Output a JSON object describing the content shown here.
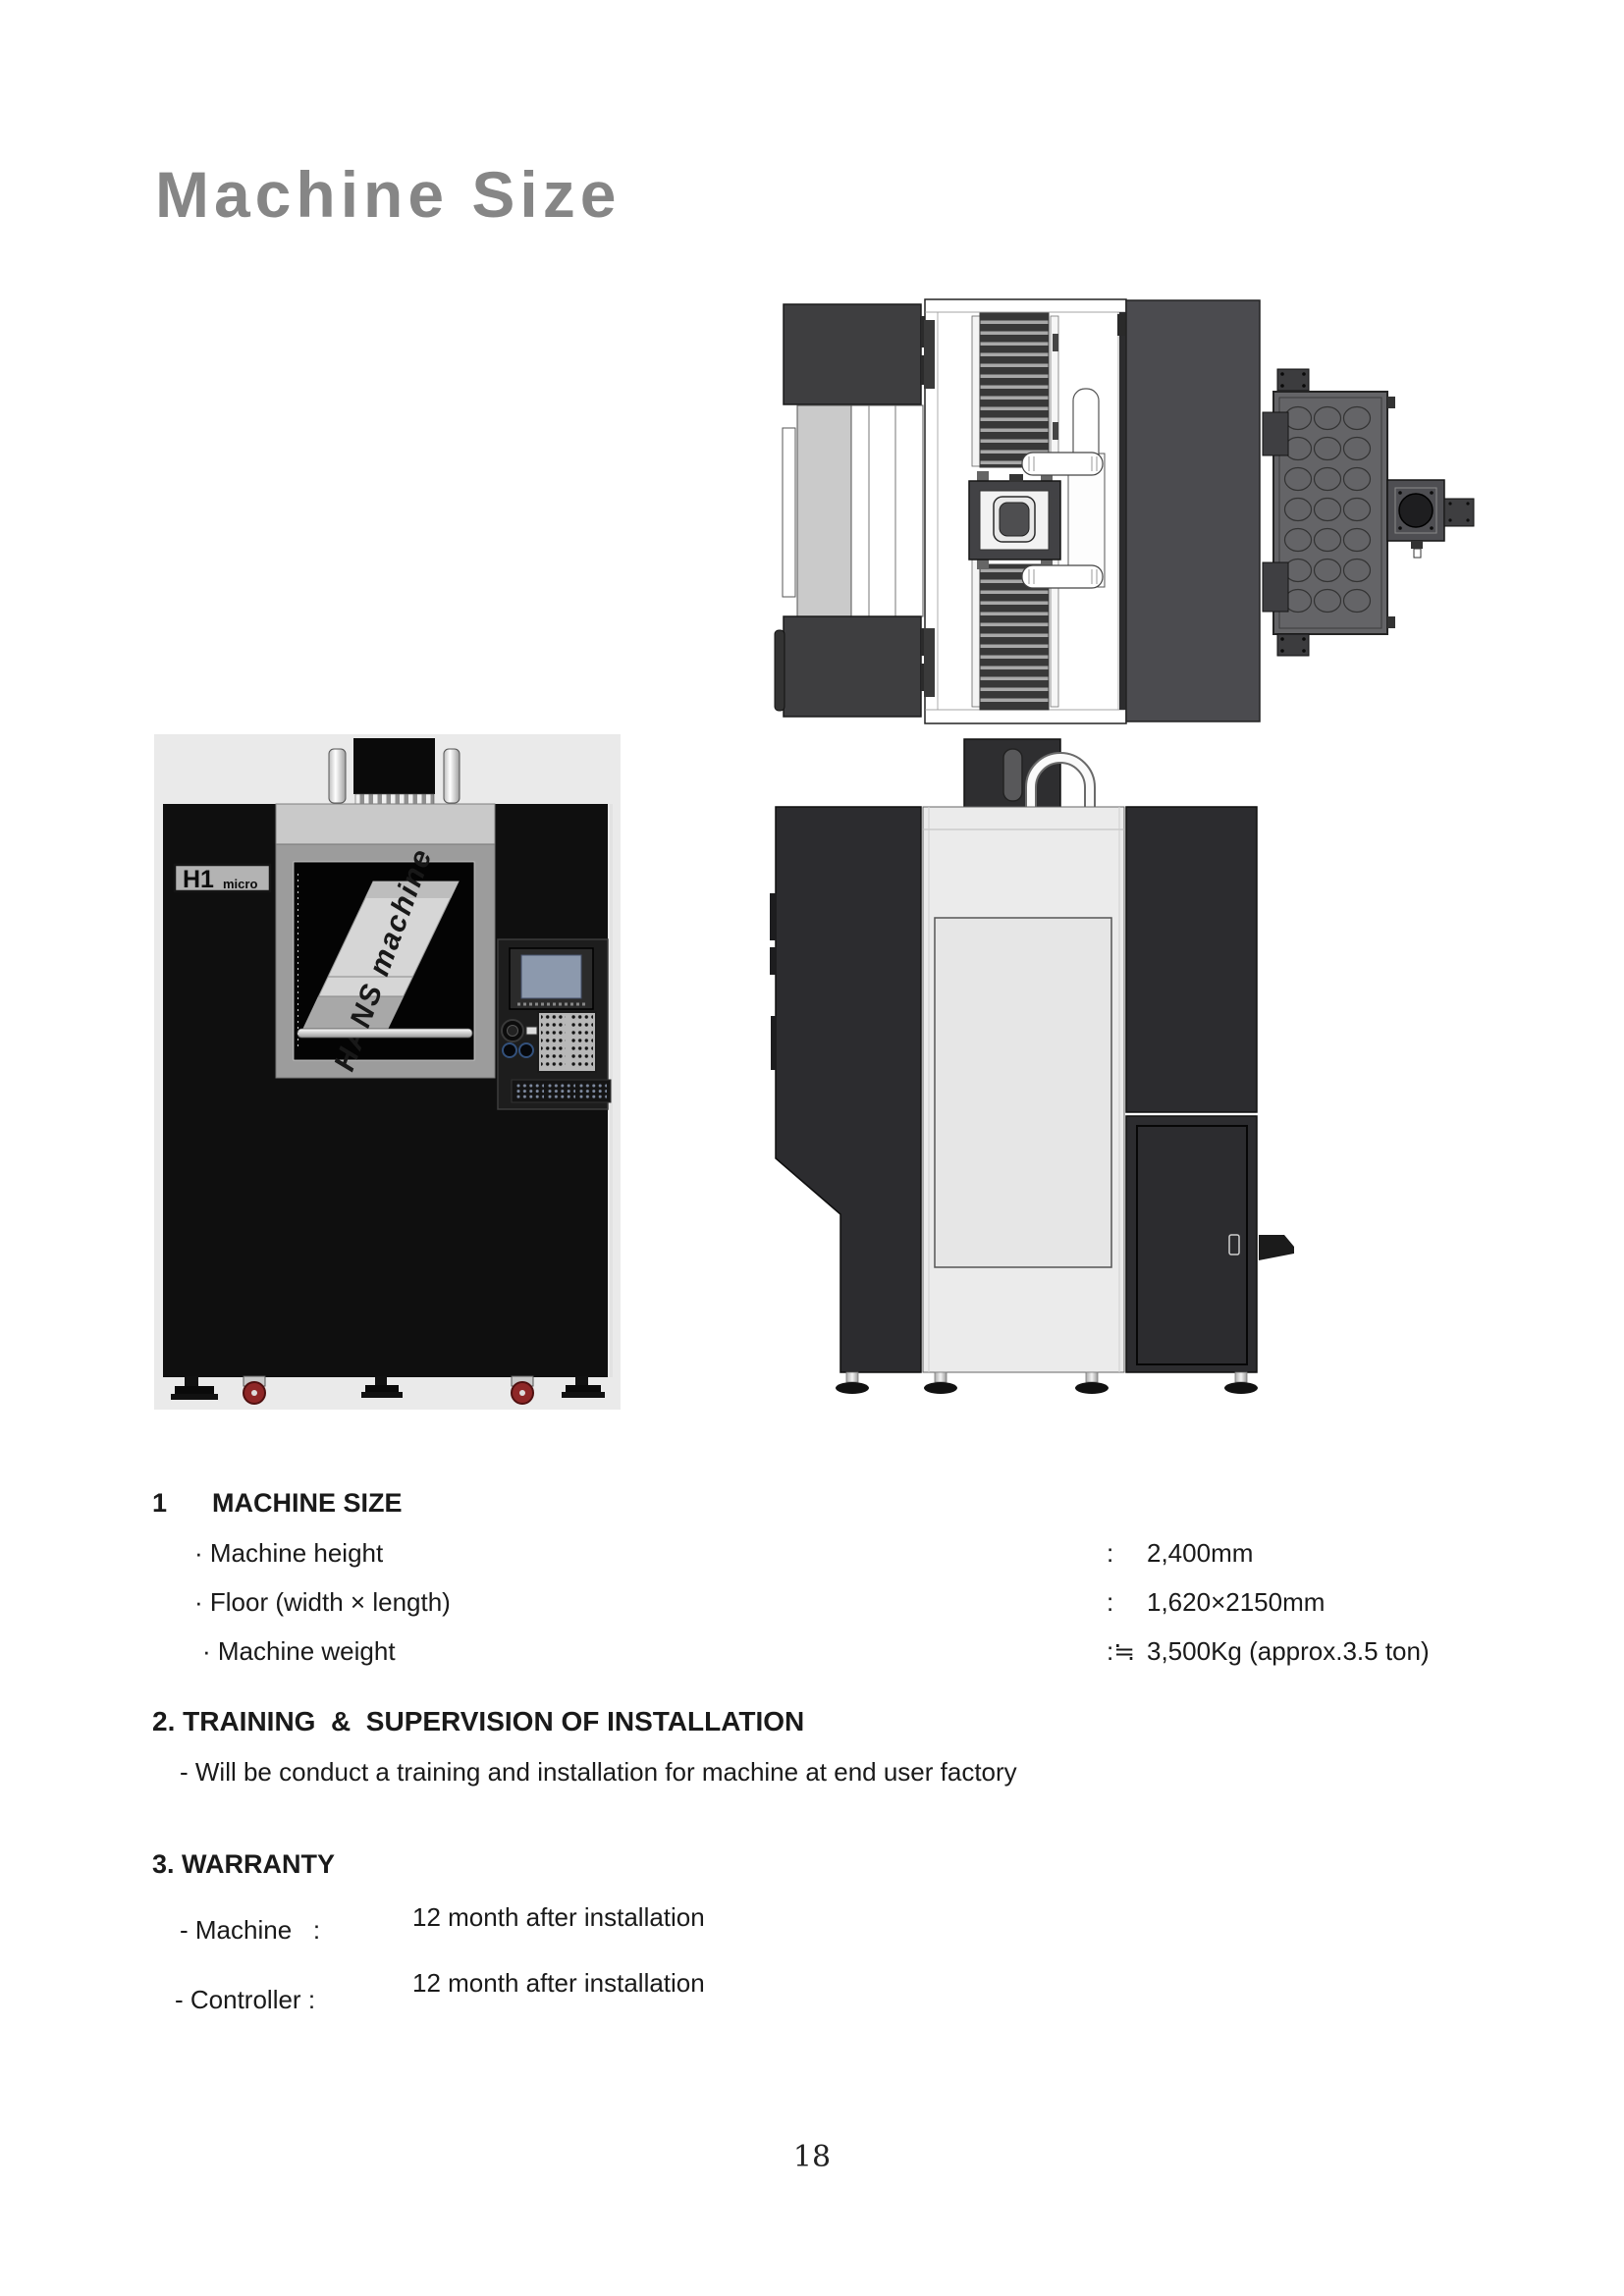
{
  "title": "Machine Size",
  "front_view": {
    "model_label": "H1",
    "model_label_sub": "micro",
    "door_text": "HANS machine"
  },
  "sections": {
    "s1": {
      "num": "1",
      "heading": "MACHINE SIZE",
      "rows": [
        {
          "label": "· Machine height",
          "colon": ":",
          "value": "2,400mm"
        },
        {
          "label": "· Floor (width × length)",
          "colon": ":",
          "value": "1,620×2150mm"
        },
        {
          "label": "· Machine weight",
          "colon": ":≒",
          "value": "3,500Kg (approx.3.5 ton)"
        }
      ]
    },
    "s2": {
      "heading": "2. TRAINING  &  SUPERVISION OF INSTALLATION",
      "body": "- Will be conduct a training and installation for machine at end user factory"
    },
    "s3": {
      "heading": "3. WARRANTY",
      "rows": [
        {
          "label": "- Machine   :",
          "value": "12 month after installation"
        },
        {
          "label": "- Controller :",
          "value": "12 month after installation"
        }
      ]
    }
  },
  "page": {
    "number": "18"
  },
  "colors": {
    "title_gray": "#868686",
    "machine_body_black": "#0f0f0f",
    "drawing_dark_gray": "#4b4b4f",
    "control_screen_blue": "#8c99ad",
    "caster_red": "#8e2727"
  }
}
